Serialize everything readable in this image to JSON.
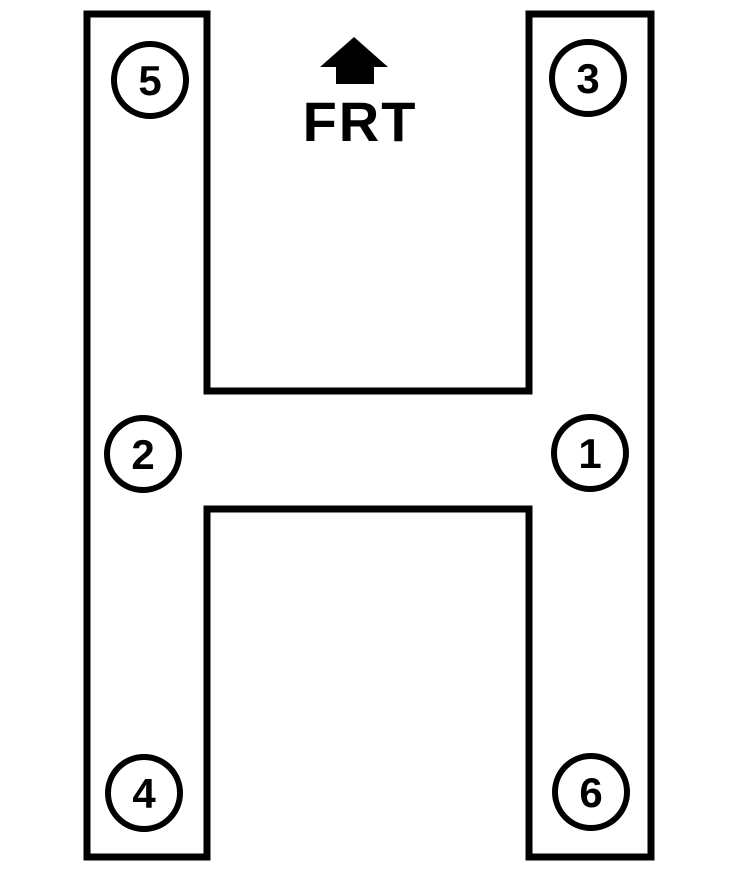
{
  "diagram": {
    "front_label": "FRT",
    "cylinders": [
      {
        "label": "5",
        "position": "front-left"
      },
      {
        "label": "3",
        "position": "front-right"
      },
      {
        "label": "2",
        "position": "middle-left"
      },
      {
        "label": "1",
        "position": "middle-right"
      },
      {
        "label": "4",
        "position": "rear-left"
      },
      {
        "label": "6",
        "position": "rear-right"
      }
    ],
    "colors": {
      "line": "#000000",
      "background": "#ffffff"
    }
  }
}
